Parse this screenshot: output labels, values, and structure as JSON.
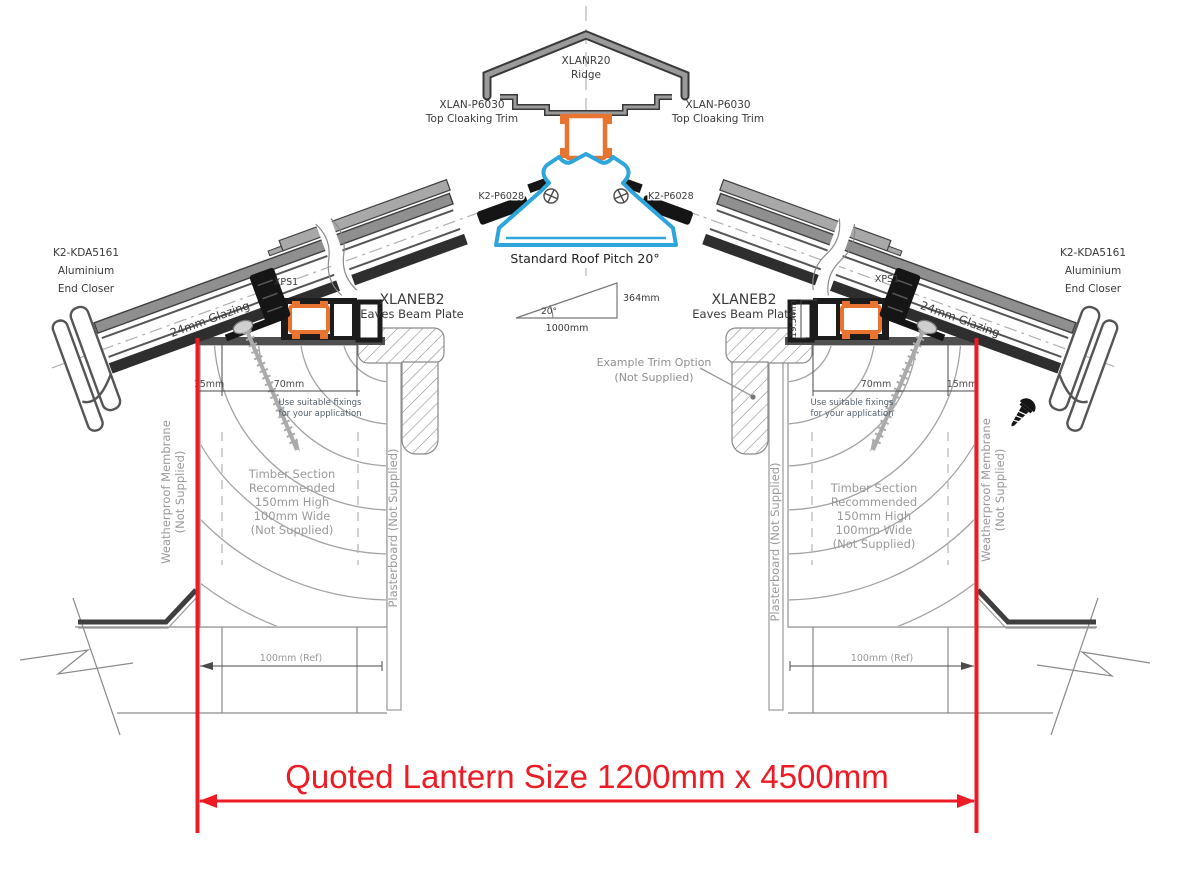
{
  "drawing": {
    "ridge": {
      "code": "XLANR20",
      "name": "Ridge"
    },
    "cloaking_trim": {
      "code": "XLAN-P6030",
      "name": "Top Cloaking Trim"
    },
    "ridge_fixing": {
      "code": "K2-P6028"
    },
    "pitch": {
      "label": "Standard Roof Pitch 20°",
      "angle": "20°",
      "base": "1000mm",
      "rise": "364mm"
    },
    "end_closer": {
      "code": "K2-KDA5161",
      "line2": "Aluminium",
      "line3": "End Closer"
    },
    "glazing": {
      "label": "24mm Glazing"
    },
    "eaves_beam": {
      "code": "XLANEB2",
      "name": "Eaves Beam Plate"
    },
    "insulation": {
      "code": "XPS1"
    },
    "dims": {
      "edge_offset": "15mm",
      "beam_width": "70mm",
      "beam_height": "19.5mm",
      "wall_ref": "100mm (Ref)"
    },
    "fixing_note": {
      "line1": "Use suitable fixings",
      "line2": "for your application"
    },
    "timber_note": {
      "line1": "Timber Section",
      "line2": "Recommended",
      "line3": "150mm High",
      "line4": "100mm Wide",
      "line5": "(Not Supplied)"
    },
    "membrane": {
      "line1": "Weatherproof Membrane",
      "line2": "(Not Supplied)"
    },
    "plasterboard": {
      "label": "Plasterboard (Not Supplied)"
    },
    "trim_option": {
      "line1": "Example Trim Option",
      "line2": "(Not Supplied)"
    },
    "quoted_size": "Quoted Lantern Size 1200mm x 4500mm",
    "colors": {
      "accent_orange": "#e87430",
      "accent_blue": "#2ea5db",
      "dimension_red": "#ec1b24",
      "aluminium_gray": "#9a9a9a"
    }
  }
}
